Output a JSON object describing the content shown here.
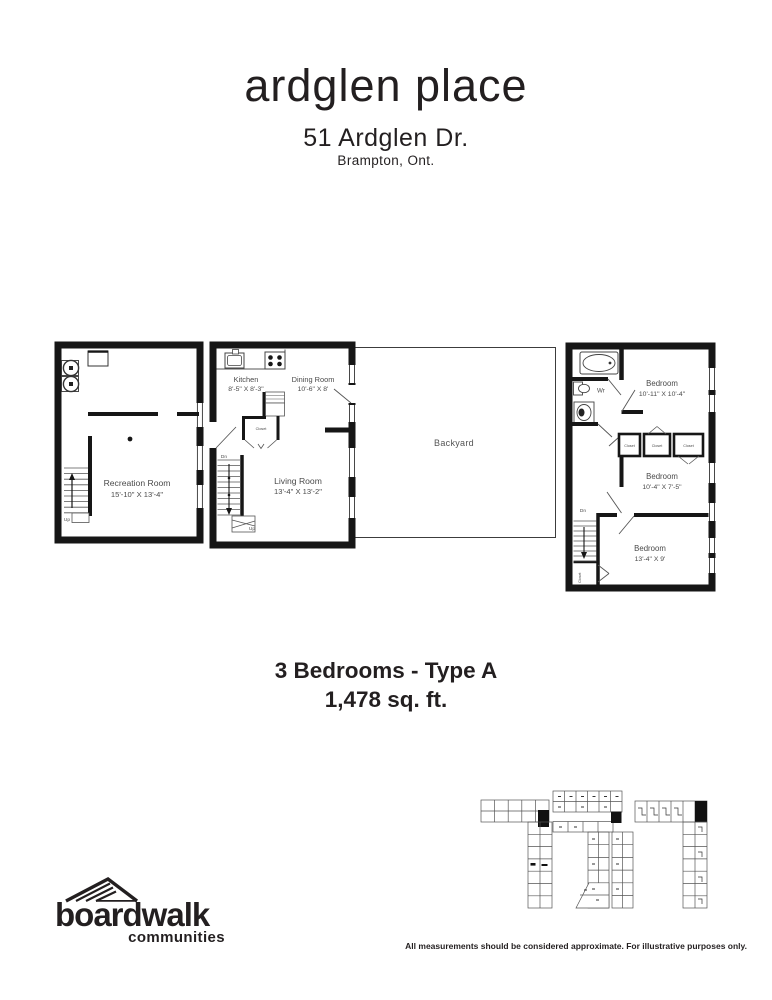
{
  "header": {
    "title": "ardglen place",
    "address": "51 Ardglen Dr.",
    "city": "Brampton, Ont."
  },
  "summary": {
    "unit_type": "3 Bedrooms - Type A",
    "area": "1,478 sq. ft."
  },
  "basement": {
    "room": "Recreation Room",
    "dims": "15'-10\" X 13'-4\"",
    "up": "Up"
  },
  "main": {
    "kitchen": "Kitchen",
    "kitchen_dims": "8'-5\" X 8'-3\"",
    "dining": "Dining Room",
    "dining_dims": "10'-6\" X 8'",
    "living": "Living Room",
    "living_dims": "13'-4\" X 13'-2\"",
    "closet": "Closet",
    "dn": "Dn",
    "up": "Up"
  },
  "backyard": {
    "label": "Backyard"
  },
  "upper": {
    "bedroom1": "Bedroom",
    "bedroom1_dims": "10'-11\" X 10'-4\"",
    "bedroom2": "Bedroom",
    "bedroom2_dims": "10'-4\" X 7'-5\"",
    "bedroom3": "Bedroom",
    "bedroom3_dims": "13'-4\" X 9'",
    "wr": "Wr",
    "closet1": "Closet",
    "closet2": "Closet",
    "closet3": "Closet",
    "closet_stairs": "Closet",
    "dn": "Dn"
  },
  "logo": {
    "name": "boardwalk",
    "tagline": "communities"
  },
  "footer": {
    "disclaimer": "All measurements should be considered approximate. For illustrative purposes only."
  }
}
